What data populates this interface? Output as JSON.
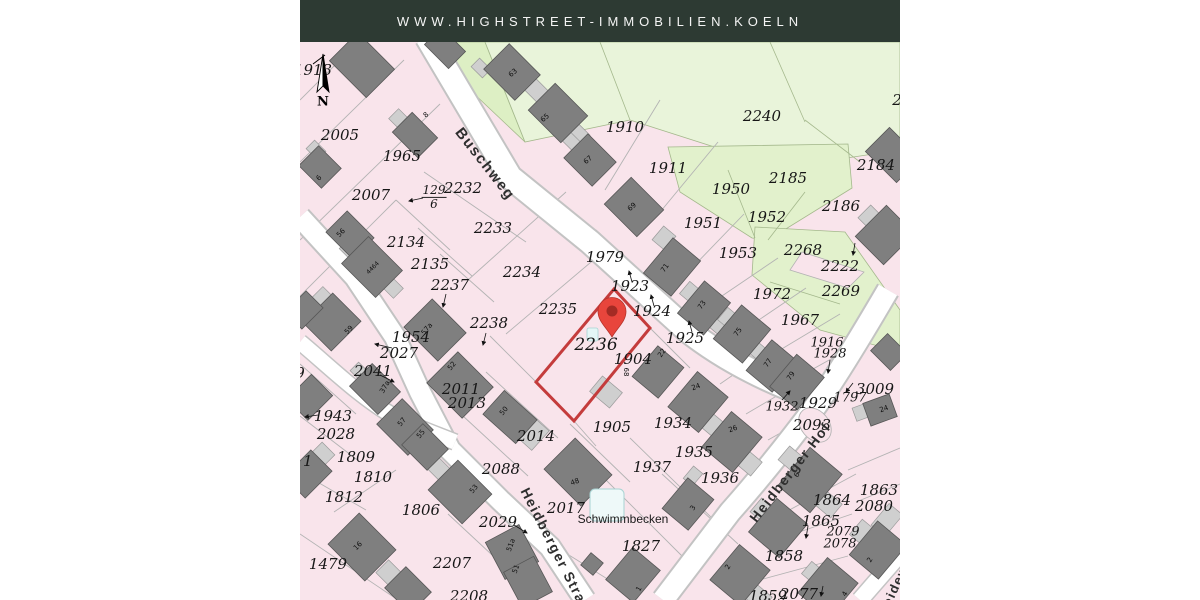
{
  "header": {
    "url": "WWW.HIGHSTREET-IMMOBILIEN.KOELN"
  },
  "colors": {
    "header_bg": "#2d3a33",
    "map_pink": "#f9e4eb",
    "green_bright": "#ddefc4",
    "green_pale": "#e9f4da",
    "building_dark": "#7f7f7f",
    "building_light": "#cfcfcf",
    "street": "#ffffff",
    "boundary": "#b3b3b3",
    "highlight_red": "#c43c3c",
    "pin_red": "#e8453c"
  },
  "map": {
    "compass": {
      "label": "N"
    },
    "highlight": {
      "parcel": "2236"
    },
    "fraction": {
      "numerator": "129",
      "denominator": "6"
    },
    "streets": [
      {
        "t": "Buschweg",
        "x": 185,
        "y": 122,
        "rot": 52,
        "fs": 15
      },
      {
        "t": "Heidberger Straße",
        "x": 258,
        "y": 512,
        "rot": 63,
        "fs": 14
      },
      {
        "t": "Heidberger Hof",
        "x": 490,
        "y": 430,
        "rot": -52,
        "fs": 14
      },
      {
        "t": "Heideweg",
        "x": 597,
        "y": 540,
        "rot": -65,
        "fs": 13
      }
    ],
    "area_labels": [
      {
        "t": "Schwimmbecken",
        "x": 323,
        "y": 477
      }
    ],
    "parcel_labels": [
      {
        "t": "1913",
        "x": 13,
        "y": 28
      },
      {
        "t": "2005",
        "x": 40,
        "y": 93
      },
      {
        "t": "1965",
        "x": 102,
        "y": 114
      },
      {
        "t": "2007",
        "x": 71,
        "y": 153
      },
      {
        "t": "2232",
        "x": 163,
        "y": 146
      },
      {
        "t": "2233",
        "x": 193,
        "y": 186
      },
      {
        "t": "2134",
        "x": 106,
        "y": 200
      },
      {
        "t": "2135",
        "x": 130,
        "y": 222
      },
      {
        "t": "2237",
        "x": 150,
        "y": 243
      },
      {
        "t": "2234",
        "x": 222,
        "y": 230
      },
      {
        "t": "2235",
        "x": 258,
        "y": 267
      },
      {
        "t": "2238",
        "x": 189,
        "y": 281
      },
      {
        "t": "1954",
        "x": 111,
        "y": 295
      },
      {
        "t": "2027",
        "x": 99,
        "y": 311
      },
      {
        "t": "2041",
        "x": 73,
        "y": 329
      },
      {
        "t": "2011",
        "x": 161,
        "y": 347
      },
      {
        "t": "2013",
        "x": 167,
        "y": 361
      },
      {
        "t": "1943",
        "x": 33,
        "y": 374
      },
      {
        "t": "2028",
        "x": 36,
        "y": 392
      },
      {
        "t": "1809",
        "x": 56,
        "y": 415
      },
      {
        "t": "1810",
        "x": 73,
        "y": 435
      },
      {
        "t": "1812",
        "x": 44,
        "y": 455
      },
      {
        "t": "1806",
        "x": 121,
        "y": 468
      },
      {
        "t": "1479",
        "x": 28,
        "y": 522
      },
      {
        "t": "2207",
        "x": 152,
        "y": 521
      },
      {
        "t": "2208",
        "x": 169,
        "y": 554
      },
      {
        "t": "2029",
        "x": 198,
        "y": 480
      },
      {
        "t": "2088",
        "x": 201,
        "y": 427
      },
      {
        "t": "2014",
        "x": 236,
        "y": 394
      },
      {
        "t": "2017",
        "x": 266,
        "y": 466
      },
      {
        "t": "1827",
        "x": 341,
        "y": 504
      },
      {
        "t": "1905",
        "x": 312,
        "y": 385
      },
      {
        "t": "1937",
        "x": 352,
        "y": 425
      },
      {
        "t": "1934",
        "x": 373,
        "y": 381
      },
      {
        "t": "1935",
        "x": 394,
        "y": 410
      },
      {
        "t": "1936",
        "x": 420,
        "y": 436
      },
      {
        "t": "1910",
        "x": 325,
        "y": 85
      },
      {
        "t": "1911",
        "x": 368,
        "y": 126
      },
      {
        "t": "1979",
        "x": 305,
        "y": 215
      },
      {
        "t": "1923",
        "x": 330,
        "y": 244
      },
      {
        "t": "1924",
        "x": 352,
        "y": 269
      },
      {
        "t": "1925",
        "x": 385,
        "y": 296
      },
      {
        "t": "1904",
        "x": 333,
        "y": 317
      },
      {
        "t": "2236",
        "x": 296,
        "y": 303,
        "fs": 17
      },
      {
        "t": "1950",
        "x": 431,
        "y": 147
      },
      {
        "t": "1951",
        "x": 403,
        "y": 181
      },
      {
        "t": "1952",
        "x": 467,
        "y": 175
      },
      {
        "t": "1953",
        "x": 438,
        "y": 211
      },
      {
        "t": "2240",
        "x": 462,
        "y": 74
      },
      {
        "t": "2185",
        "x": 488,
        "y": 136
      },
      {
        "t": "2184",
        "x": 576,
        "y": 123
      },
      {
        "t": "2186",
        "x": 541,
        "y": 164
      },
      {
        "t": "2268",
        "x": 503,
        "y": 208
      },
      {
        "t": "2222",
        "x": 540,
        "y": 224
      },
      {
        "t": "2269",
        "x": 541,
        "y": 249
      },
      {
        "t": "1972",
        "x": 472,
        "y": 252
      },
      {
        "t": "1967",
        "x": 500,
        "y": 278
      },
      {
        "t": "1916",
        "x": 527,
        "y": 301,
        "fs": 13
      },
      {
        "t": "1928",
        "x": 530,
        "y": 312,
        "fs": 13
      },
      {
        "t": "1932",
        "x": 482,
        "y": 365,
        "fs": 13
      },
      {
        "t": "1929",
        "x": 518,
        "y": 361
      },
      {
        "t": "3009",
        "x": 575,
        "y": 347
      },
      {
        "t": "1797",
        "x": 550,
        "y": 356,
        "fs": 13
      },
      {
        "t": "2093",
        "x": 512,
        "y": 383
      },
      {
        "t": "1864",
        "x": 532,
        "y": 458
      },
      {
        "t": "1863",
        "x": 579,
        "y": 448
      },
      {
        "t": "2080",
        "x": 574,
        "y": 464
      },
      {
        "t": "1865",
        "x": 521,
        "y": 479
      },
      {
        "t": "2079",
        "x": 543,
        "y": 490,
        "fs": 13
      },
      {
        "t": "2078",
        "x": 540,
        "y": 502,
        "fs": 13
      },
      {
        "t": "1858",
        "x": 484,
        "y": 514
      },
      {
        "t": "1859",
        "x": 468,
        "y": 554
      },
      {
        "t": "2077",
        "x": 499,
        "y": 552
      },
      {
        "t": "2",
        "x": 597,
        "y": 58
      },
      {
        "t": "9",
        "x": 0,
        "y": 331
      },
      {
        "t": "11",
        "x": 3,
        "y": 419
      }
    ],
    "house_numbers": [
      {
        "t": "8",
        "x": 126,
        "y": 73,
        "rot": -40
      },
      {
        "t": "63",
        "x": 213,
        "y": 31,
        "rot": -40
      },
      {
        "t": "65",
        "x": 245,
        "y": 76,
        "rot": -40
      },
      {
        "t": "67",
        "x": 288,
        "y": 118,
        "rot": -40
      },
      {
        "t": "69",
        "x": 332,
        "y": 165,
        "rot": -40
      },
      {
        "t": "6",
        "x": 19,
        "y": 136,
        "rot": -45
      },
      {
        "t": "56",
        "x": 41,
        "y": 191,
        "rot": -45
      },
      {
        "t": "59",
        "x": 49,
        "y": 288,
        "rot": -45
      },
      {
        "t": "4464",
        "x": 73,
        "y": 226,
        "rot": -45,
        "fs": 6
      },
      {
        "t": "57a",
        "x": 127,
        "y": 287,
        "rot": -50
      },
      {
        "t": "37a",
        "x": 85,
        "y": 345,
        "rot": -60
      },
      {
        "t": "52",
        "x": 152,
        "y": 324,
        "rot": -50
      },
      {
        "t": "50",
        "x": 204,
        "y": 369,
        "rot": -50
      },
      {
        "t": "57",
        "x": 102,
        "y": 380,
        "rot": -50
      },
      {
        "t": "55",
        "x": 121,
        "y": 392,
        "rot": -50
      },
      {
        "t": "53",
        "x": 174,
        "y": 447,
        "rot": -50
      },
      {
        "t": "51a",
        "x": 211,
        "y": 503,
        "rot": -70
      },
      {
        "t": "51",
        "x": 216,
        "y": 527,
        "rot": -70
      },
      {
        "t": "16",
        "x": 58,
        "y": 504,
        "rot": -45
      },
      {
        "t": "71",
        "x": 365,
        "y": 226,
        "rot": -55
      },
      {
        "t": "73",
        "x": 402,
        "y": 263,
        "rot": -55
      },
      {
        "t": "75",
        "x": 438,
        "y": 290,
        "rot": -55
      },
      {
        "t": "77",
        "x": 468,
        "y": 321,
        "rot": -55
      },
      {
        "t": "79",
        "x": 491,
        "y": 334,
        "rot": -55
      },
      {
        "t": "22",
        "x": 362,
        "y": 311,
        "rot": -55
      },
      {
        "t": "24",
        "x": 396,
        "y": 345,
        "rot": -20
      },
      {
        "t": "26",
        "x": 433,
        "y": 387,
        "rot": -20
      },
      {
        "t": "68",
        "x": 326,
        "y": 330,
        "rot": 90
      },
      {
        "t": "48",
        "x": 275,
        "y": 440,
        "rot": -20
      },
      {
        "t": "3",
        "x": 393,
        "y": 466,
        "rot": -60
      },
      {
        "t": "1",
        "x": 339,
        "y": 547,
        "rot": -60
      },
      {
        "t": "2",
        "x": 428,
        "y": 525,
        "rot": -60
      },
      {
        "t": "4",
        "x": 545,
        "y": 552,
        "rot": -60
      },
      {
        "t": "6",
        "x": 497,
        "y": 433,
        "rot": -60
      },
      {
        "t": "24",
        "x": 584,
        "y": 367,
        "rot": -20
      },
      {
        "t": "2",
        "x": 570,
        "y": 518,
        "rot": -60
      }
    ]
  }
}
